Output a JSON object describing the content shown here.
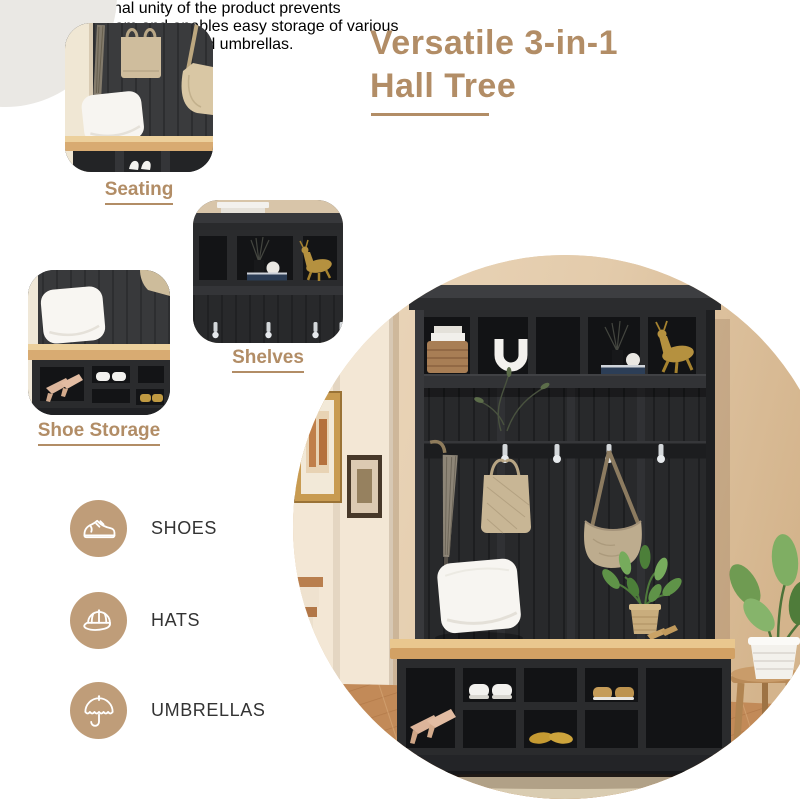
{
  "header": {
    "title_line1": "Versatile 3-in-1",
    "title_line2": "Hall Tree",
    "description_lines": [
      "The multifunctional unity of the product prevents",
      "clutter in your room and enables easy storage of various",
      "items such as shoes,hats, and umbrellas."
    ]
  },
  "callouts": {
    "seating": {
      "label": "Seating"
    },
    "shelves": {
      "label": "Shelves"
    },
    "shoe_storage": {
      "label": "Shoe Storage"
    }
  },
  "features": [
    {
      "icon": "sneaker-icon",
      "label": "SHOES"
    },
    {
      "icon": "cap-icon",
      "label": "HATS"
    },
    {
      "icon": "umbrella-icon",
      "label": "UMBRELLAS"
    }
  ],
  "colors": {
    "accent_tan": "#b28d66",
    "icon_circle_tan": "#bf9d79",
    "body_text": "#3d3d3d",
    "furniture_black": "#2a2b2d",
    "bench_wood": "#d2a164",
    "wall_beige": "#e3cbab",
    "background": "#ffffff"
  }
}
